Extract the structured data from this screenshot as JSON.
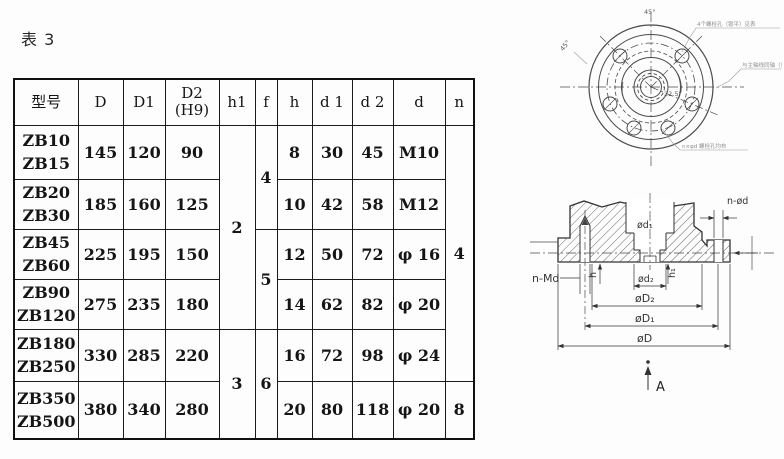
{
  "title": "表 3",
  "table": {
    "headers": [
      "型号",
      "D",
      "D1",
      "D2\n(H9)",
      "h1",
      "f",
      "h",
      "d 1",
      "d 2",
      "d",
      "n"
    ],
    "rows": [
      {
        "model": "ZB10\nZB15",
        "D": "145",
        "D1": "120",
        "D2": "90",
        "h": "8",
        "d1": "30",
        "d2": "45",
        "d": "M10"
      },
      {
        "model": "ZB20\nZB30",
        "D": "185",
        "D1": "160",
        "D2": "125",
        "h": "10",
        "d1": "42",
        "d2": "58",
        "d": "M12"
      },
      {
        "model": "ZB45\nZB60",
        "D": "225",
        "D1": "195",
        "D2": "150",
        "h": "12",
        "d1": "50",
        "d2": "72",
        "d": "φ 16"
      },
      {
        "model": "ZB90\nZB120",
        "D": "275",
        "D1": "235",
        "D2": "180",
        "h": "14",
        "d1": "62",
        "d2": "82",
        "d": "φ 20"
      },
      {
        "model": "ZB180\nZB250",
        "D": "330",
        "D1": "285",
        "D2": "220",
        "h": "16",
        "d1": "72",
        "d2": "98",
        "d": "φ 24"
      },
      {
        "model": "ZB350\nZB500",
        "D": "380",
        "D1": "340",
        "D2": "280",
        "h": "20",
        "d1": "80",
        "d2": "118",
        "d": "φ 20"
      }
    ],
    "spans": {
      "h1": [
        "2",
        "3"
      ],
      "f": [
        "4",
        "5",
        "6"
      ],
      "n": [
        "4",
        "8"
      ]
    }
  },
  "front": {
    "angle_top": "45°",
    "angle_left": "45°",
    "angle_mid": "22.5°",
    "anno_top_right": "4个螺栓孔（锪平）见表",
    "anno_right": "与主轴线同轴（见表）",
    "anno_bottom": "n×φd 螺栓孔均布"
  },
  "section": {
    "labels": {
      "d1": "ød₁",
      "nd": "n-ød",
      "nmd": "n-Md",
      "h": "h",
      "d2": "ød₂",
      "h1": "h₁",
      "D2": "øD₂",
      "D1": "øD₁",
      "D": "øD",
      "view": "A"
    }
  }
}
